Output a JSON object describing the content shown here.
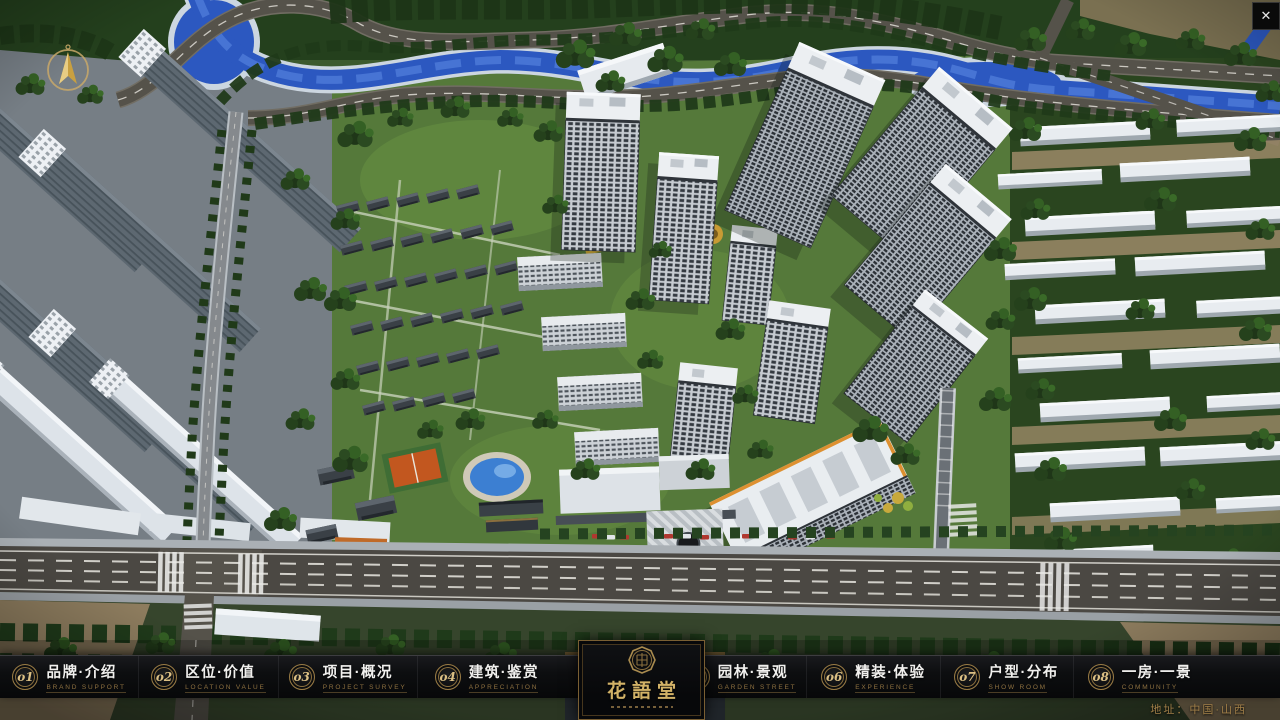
{
  "window": {
    "close_label": "✕"
  },
  "palette": {
    "gold": "#c9a25e",
    "gold_dim": "#8e7140",
    "bar_bg": "#0b0c0e",
    "text": "#f1f0ee",
    "river_blue": "#2c58c0",
    "lawn_green": "#55793a"
  },
  "nav": {
    "items": [
      {
        "num": "o1",
        "zh": "品牌·介绍",
        "en": "BRAND SUPPORT"
      },
      {
        "num": "o2",
        "zh": "区位·价值",
        "en": "LOCATION VALUE"
      },
      {
        "num": "o3",
        "zh": "项目·概况",
        "en": "PROJECT SURVEY"
      },
      {
        "num": "o4",
        "zh": "建筑·鉴赏",
        "en": "APPRECIATION"
      },
      {
        "num": "o5",
        "zh": "园林·景观",
        "en": "GARDEN STREET"
      },
      {
        "num": "o6",
        "zh": "精装·体验",
        "en": "EXPERIENCE"
      },
      {
        "num": "o7",
        "zh": "户型·分布",
        "en": "SHOW ROOM"
      },
      {
        "num": "o8",
        "zh": "一房·一景",
        "en": "COMMUNITY"
      }
    ]
  },
  "logo": {
    "title": "花語堂"
  },
  "footer": {
    "address": "地址：中国·山西"
  }
}
